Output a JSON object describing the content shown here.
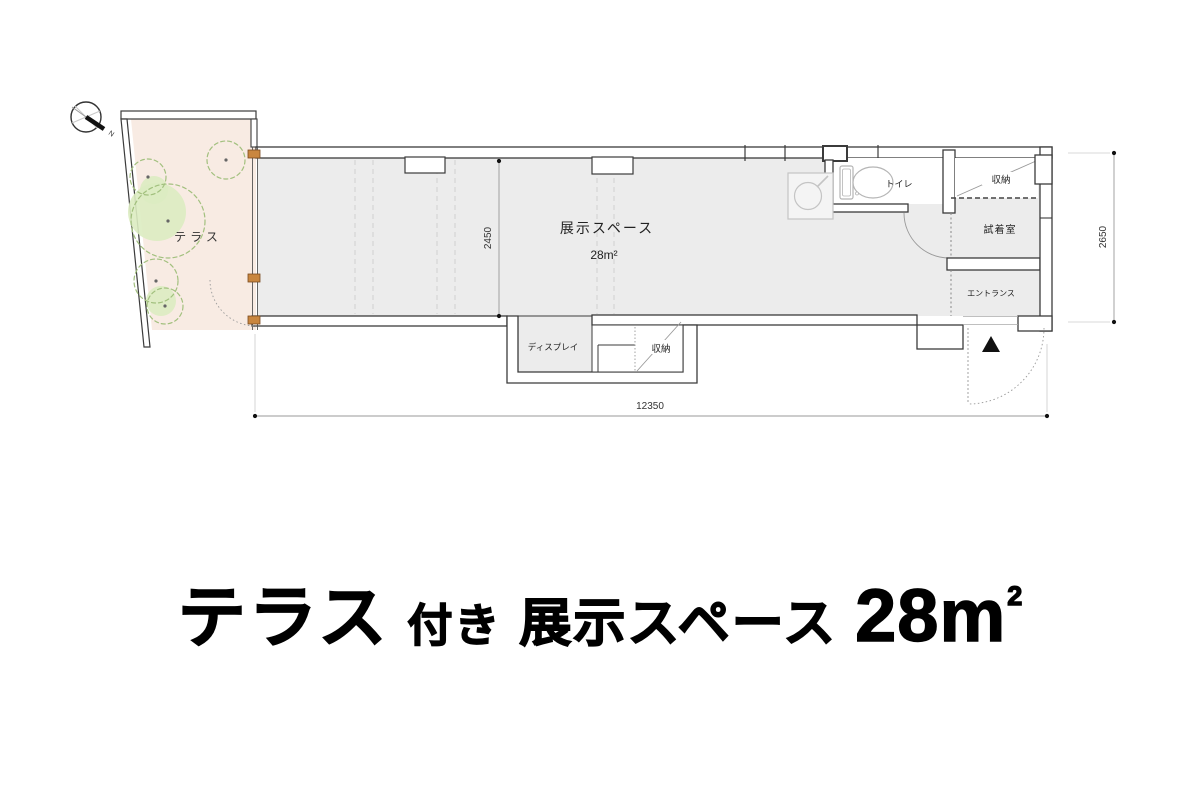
{
  "compass": {
    "north_label": "N"
  },
  "plan": {
    "terrace": {
      "label": "テラス"
    },
    "exhibition": {
      "label": "展示スペース",
      "area": "28m²"
    },
    "rooms": {
      "toilet": "トイレ",
      "storage_top": "収納",
      "fitting_room": "試着室",
      "entrance": "エントランス",
      "display": "ディスプレイ",
      "storage_bottom": "収納"
    },
    "dimensions": {
      "width": "12350",
      "depth": "2450",
      "right_depth": "2650"
    }
  },
  "title": {
    "terrace": "テラス",
    "suffix": "付き",
    "space": "展示スペース",
    "area": "28m",
    "area_sup": "2"
  },
  "colors": {
    "terrace_fill": "#f8ebe3",
    "floor_fill": "#ececec",
    "tree_fill": "#dcecc1",
    "tree_stroke": "#a2c07e",
    "wall": "#3b3b3b",
    "post": "#c9863f",
    "dimension_line": "#999999"
  }
}
